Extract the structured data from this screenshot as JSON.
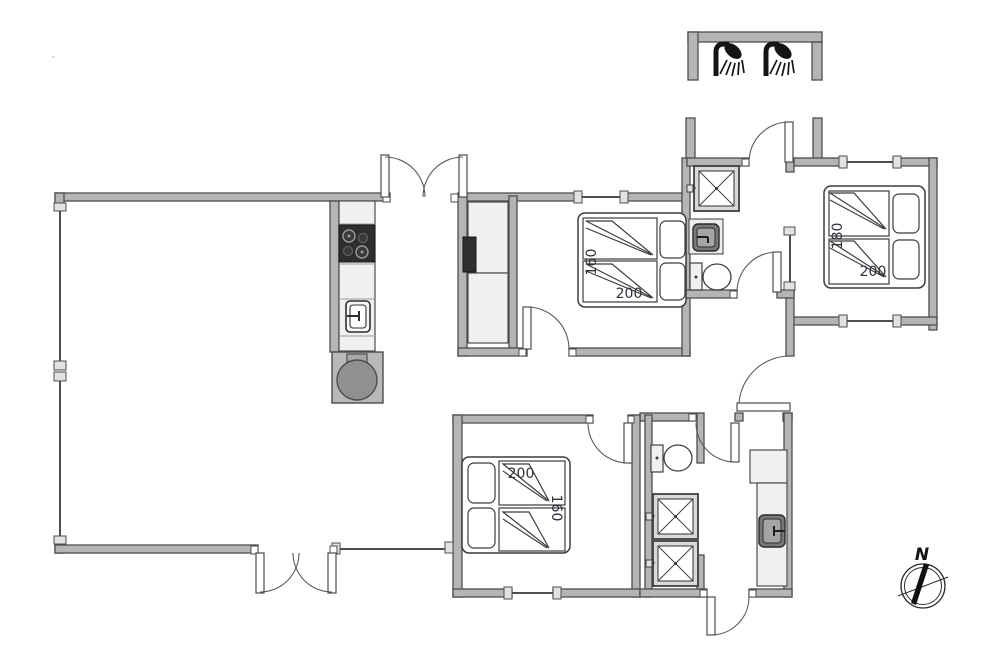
{
  "document": {
    "type": "floor-plan",
    "background": "#ffffff"
  },
  "colors": {
    "wall_fill": "#b5b5b5",
    "wall_stroke": "#4d4d4d",
    "fixture_dark": "#2e2e2e",
    "sink_basin": "#787878",
    "label_text": "#31313b"
  },
  "beds": {
    "right": {
      "width_label": "180",
      "length_label": "200"
    },
    "middle": {
      "width_label": "160",
      "length_label": "200"
    },
    "bottom": {
      "width_label": "160",
      "length_label": "200"
    }
  },
  "compass": {
    "north_label": "N"
  },
  "fixtures": [
    "outdoor-shower-icon",
    "outdoor-shower-icon",
    "shower-cabin-icon",
    "washbasin-icon",
    "toilet-icon",
    "cooktop-icon",
    "kitchen-sink-icon",
    "wood-stove-icon",
    "wardrobe",
    "double-bed",
    "double-bed",
    "double-bed",
    "toilet-icon",
    "shower-cabin-icon",
    "shower-cabin-icon",
    "utility-sink-icon",
    "compass-rose"
  ]
}
